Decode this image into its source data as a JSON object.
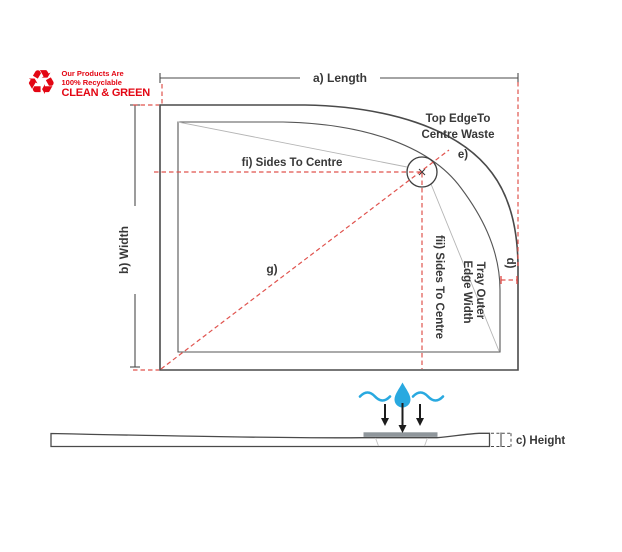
{
  "logo": {
    "icon_glyph": "♻",
    "line1": "Our Products Are",
    "line2": "100% Recyclable",
    "line3": "CLEAN & GREEN",
    "color": "#e30613"
  },
  "diagram": {
    "title": "Offset quadrant shower tray dimension diagram",
    "labels": {
      "length": "a) Length",
      "width": "b) Width",
      "height": "c) Height",
      "d": "d)",
      "tray_outer_line1": "Tray Outer",
      "tray_outer_line2": "Edge Width",
      "top_edge_line1": "Top EdgeTo",
      "top_edge_line2": "Centre Waste",
      "e": "e)",
      "sides_to_centre_i": "fi) Sides To Centre",
      "sides_to_centre_ii": "fii) Sides To Centre",
      "g": "g)"
    },
    "colors": {
      "outline": "#4a4a4a",
      "dimension_red": "#e0534e",
      "water_blue": "#29a9e0",
      "waste_bar": "#8f969b",
      "slope_line_gray": "#b5b5b5"
    }
  }
}
